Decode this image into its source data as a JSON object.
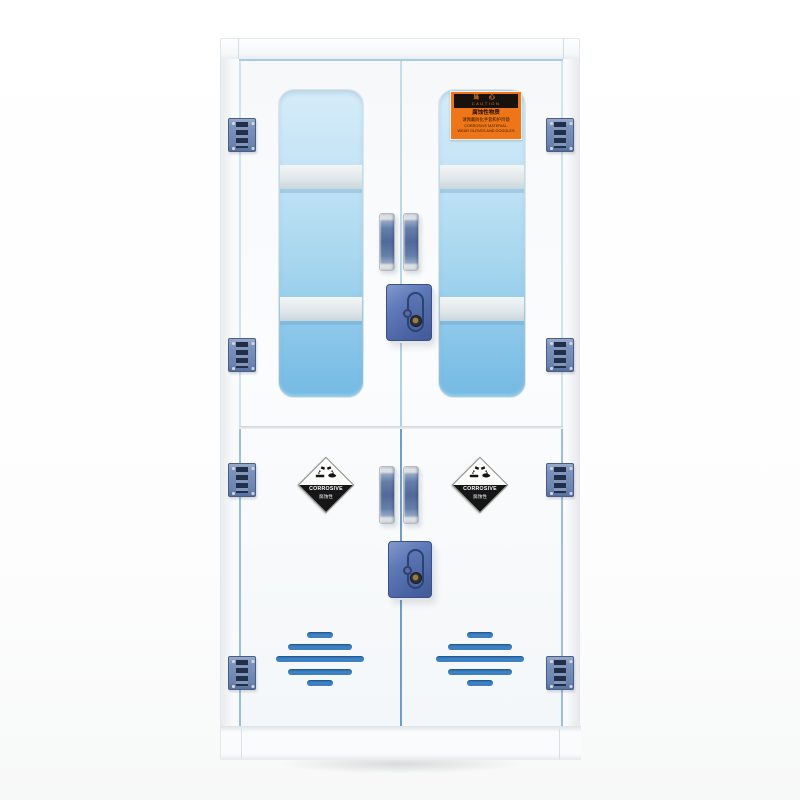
{
  "scene": {
    "subject": "White polypropylene corrosive-chemical safety storage cabinet with two blue-tinted view windows in the upper doors, blue hinges, handles and cam locks, hazard labels, and vented lower doors"
  },
  "colors": {
    "cabinet_white": "#fbfcfd",
    "window_blue": "#9fd2ee",
    "seam_blue": "#79a6cf",
    "vent_blue": "#3a7cc0",
    "hinge_blue": "#7c94bc",
    "handle_blue": "#5f7aa6",
    "lock_blue": "#5570b2",
    "label_orange": "#ee7518",
    "label_black": "#161616"
  },
  "caution_label": {
    "warn_cn": "当 心",
    "warn_en": "CAUTION",
    "material_cn": "腐蚀性物质",
    "instruction_cn": "请佩戴防化手套和护目镜",
    "material_en": "CORROSIVE MATERIAL.",
    "instruction_en": "WEAR GLOVES AND GOGGLES"
  },
  "corrosive_label": {
    "word": "CORROSIVE",
    "word_cn": "腐蚀性"
  }
}
